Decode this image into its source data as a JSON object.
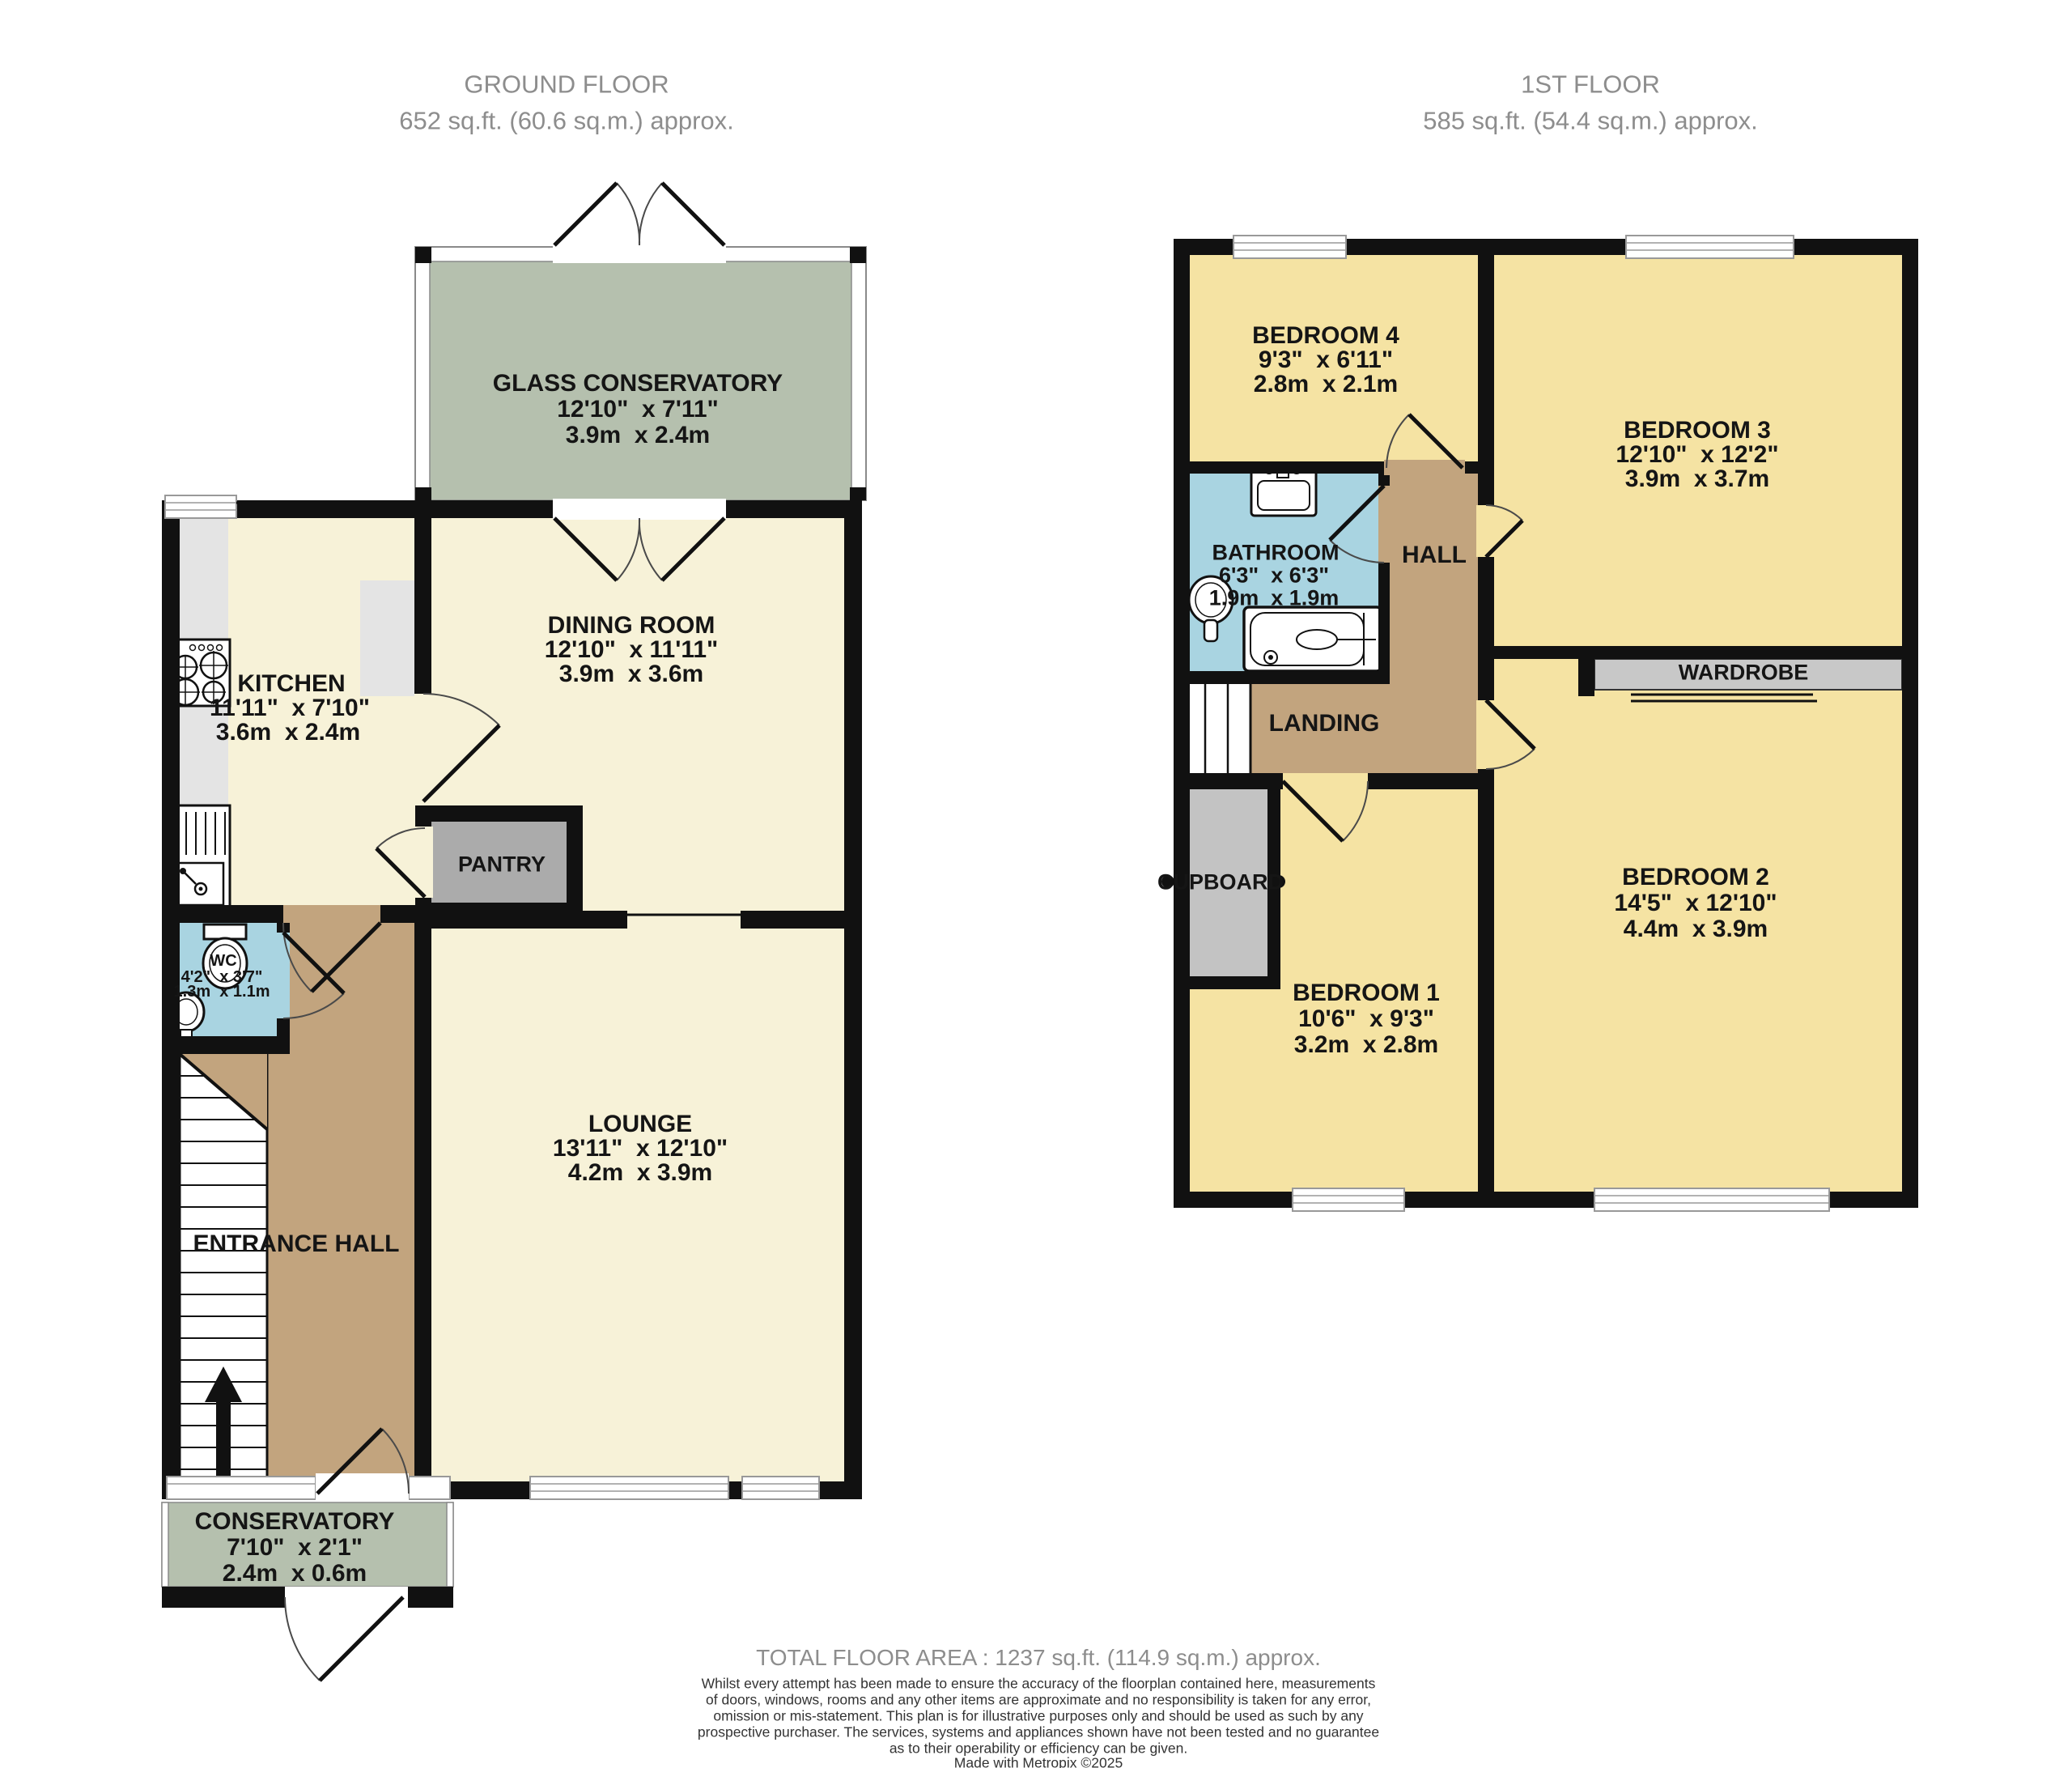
{
  "ground_floor": {
    "header_line1": "GROUND FLOOR",
    "header_line2": "652 sq.ft. (60.6 sq.m.) approx.",
    "rooms": {
      "glass_conservatory": {
        "name": "GLASS CONSERVATORY",
        "imperial": "12'10\"  x 7'11\"",
        "metric": "3.9m  x 2.4m"
      },
      "dining_room": {
        "name": "DINING ROOM",
        "imperial": "12'10\"  x 11'11\"",
        "metric": "3.9m  x 3.6m"
      },
      "kitchen": {
        "name": "KITCHEN",
        "imperial": "11'11\"  x 7'10\"",
        "metric": "3.6m  x 2.4m"
      },
      "pantry": {
        "name": "PANTRY"
      },
      "wc": {
        "name": "WC",
        "imperial": "4'2\"  x 3'7\"",
        "metric": "1.3m  x 1.1m"
      },
      "entrance_hall": {
        "name": "ENTRANCE HALL"
      },
      "lounge": {
        "name": "LOUNGE",
        "imperial": "13'11\"  x 12'10\"",
        "metric": "4.2m  x 3.9m"
      },
      "conservatory": {
        "name": "CONSERVATORY",
        "imperial": "7'10\"  x 2'1\"",
        "metric": "2.4m  x 0.6m"
      }
    }
  },
  "first_floor": {
    "header_line1": "1ST FLOOR",
    "header_line2": "585 sq.ft. (54.4 sq.m.) approx.",
    "rooms": {
      "bedroom4": {
        "name": "BEDROOM 4",
        "imperial": "9'3\"  x 6'11\"",
        "metric": "2.8m  x 2.1m"
      },
      "bedroom3": {
        "name": "BEDROOM 3",
        "imperial": "12'10\"  x 12'2\"",
        "metric": "3.9m  x 3.7m"
      },
      "bathroom": {
        "name": "BATHROOM",
        "imperial": "6'3\"  x 6'3\"",
        "metric": "1.9m  x 1.9m"
      },
      "hall": {
        "name": "HALL"
      },
      "landing": {
        "name": "LANDING"
      },
      "cupboard": {
        "name": "CUPBOARD"
      },
      "bedroom1": {
        "name": "BEDROOM 1",
        "imperial": "10'6\"  x 9'3\"",
        "metric": "3.2m  x 2.8m"
      },
      "bedroom2": {
        "name": "BEDROOM 2",
        "imperial": "14'5\"  x 12'10\"",
        "metric": "4.4m  x 3.9m"
      },
      "wardrobe": {
        "name": "WARDROBE"
      }
    }
  },
  "footer": {
    "total_area": "TOTAL FLOOR AREA : 1237 sq.ft. (114.9 sq.m.) approx.",
    "disclaimer_lines": [
      "Whilst every attempt has been made to ensure the accuracy of the floorplan contained here, measurements",
      "of doors, windows, rooms and any other items are approximate and no responsibility is taken for any error,",
      "omission or mis-statement. This plan is for illustrative purposes only and should be used as such by any",
      "prospective purchaser. The services, systems and appliances shown have not been tested and no guarantee",
      "as to their operability or efficiency can be given."
    ],
    "credit": "Made with Metropix ©2025"
  },
  "colors": {
    "wall": "#111111",
    "ground_room": "#f7f2d8",
    "bedroom": "#f5e3a3",
    "hallway": "#c2a47e",
    "wet_room": "#a9d4e1",
    "conservatory": "#b5c0ae",
    "storage_dark": "#ababab",
    "storage_light": "#c3c3c3",
    "counter": "#e4e4e4",
    "header_text": "#8d8d8d"
  }
}
